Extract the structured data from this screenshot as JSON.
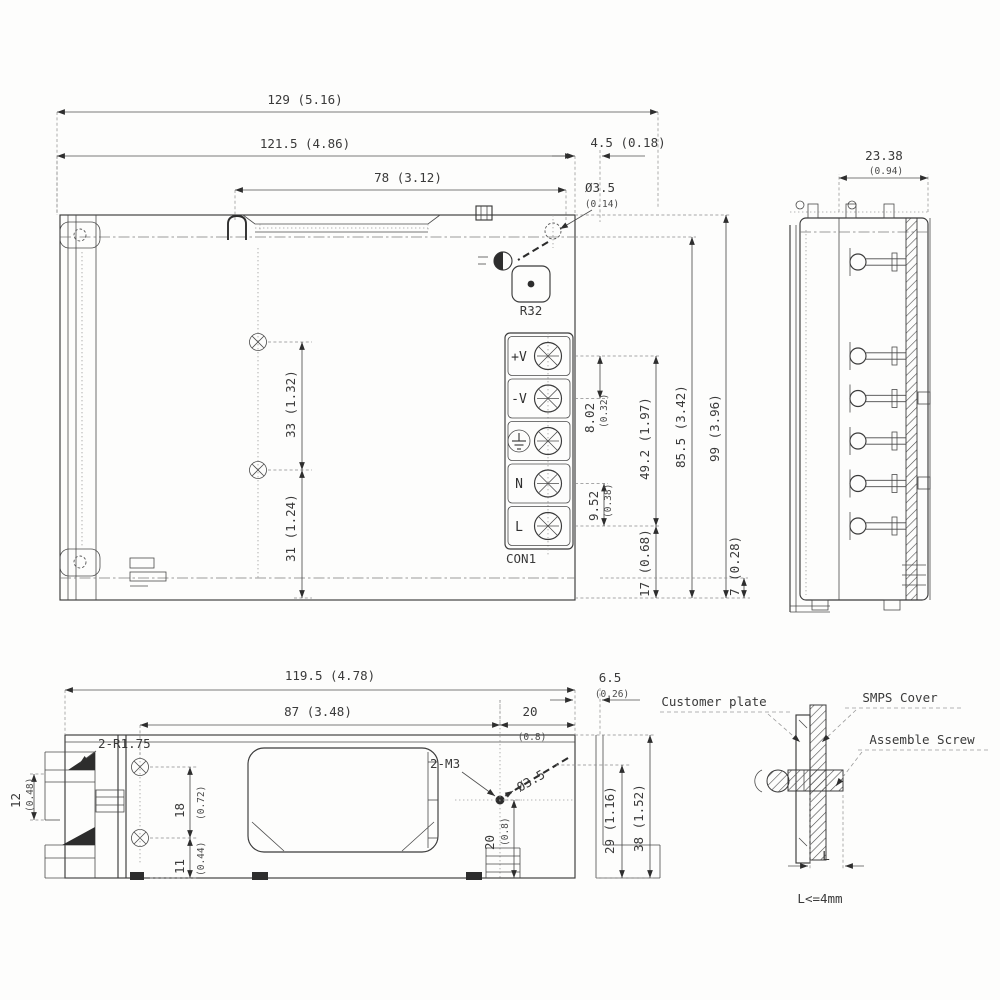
{
  "drawing": {
    "top": {
      "d_overall_w": "129 (5.16)",
      "d_body_w": "121.5 (4.86)",
      "d_vent_w": "78 (3.12)",
      "d_hole_off": "4.5 (0.18)",
      "d_hole_dia": "Ø3.5",
      "d_hole_dia_in": "(0.14)",
      "d_pitch_dc": "8.02",
      "d_pitch_dc_in": "(0.32)",
      "d_pitch_ac": "9.52",
      "d_pitch_ac_in": "(0.38)",
      "d_term_span": "49.2 (1.97)",
      "d_term_bot": "17 (0.68)",
      "d_body_d": "85.5 (3.42)",
      "d_overall_d": "99 (3.96)",
      "d_flange": "7 (0.28)",
      "d_hole_pitch": "33 (1.32)",
      "d_hole_bot": "31 (1.24)",
      "pot": "R32",
      "con": "CON1",
      "terminals": [
        "+V",
        "-V",
        "",
        "N",
        "L"
      ]
    },
    "side": {
      "d_depth": "23.38",
      "d_depth_in": "(0.94)"
    },
    "front": {
      "d_overall_w": "119.5 (4.78)",
      "d_span": "87 (3.48)",
      "d_right": "20",
      "d_right_in": "(0.8)",
      "d_bracket": "6.5",
      "d_bracket_in": "(0.26)",
      "n_slot": "2-R1.75",
      "d_slot": "12",
      "d_slot_in": "(0.48)",
      "d_ppitch": "18",
      "d_ppitch_in": "(0.72)",
      "d_pbot": "11",
      "d_pbot_in": "(0.44)",
      "n_screw": "2-M3",
      "d_dia": "Ø3.5",
      "d_hbot": "20",
      "d_hbot_in": "(0.8)",
      "d_hh": "29 (1.16)",
      "d_overall_h": "38 (1.52)"
    },
    "asm": {
      "customer": "Customer plate",
      "cover": "SMPS Cover",
      "screw": "Assemble Screw",
      "l": "L",
      "limit": "L<=4mm"
    }
  }
}
